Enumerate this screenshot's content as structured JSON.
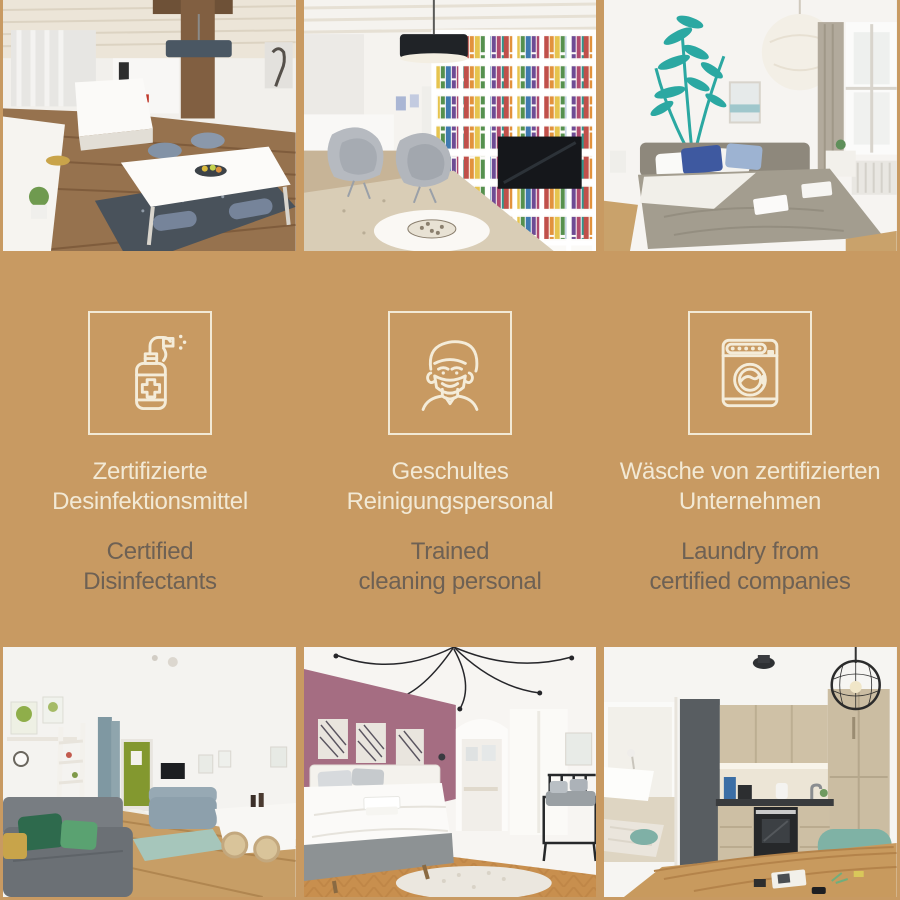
{
  "theme": {
    "background_color": "#c89a62",
    "title_color": "#f2e9d5",
    "subtitle_color": "#6e6154",
    "icon_color": "#f4ecd9"
  },
  "photo_grid": {
    "top": [
      {
        "id": "photo-open-plan-living-dining"
      },
      {
        "id": "photo-library-lounge"
      },
      {
        "id": "photo-bedroom-fern-decal"
      }
    ],
    "bottom": [
      {
        "id": "photo-living-room-green-accents"
      },
      {
        "id": "photo-bedroom-purple-wall"
      },
      {
        "id": "photo-kitchen-dining"
      }
    ]
  },
  "banner": {
    "features": [
      {
        "icon": "disinfectant-spray-icon",
        "title_de_lines": [
          "Zertifizierte",
          "Desinfektionsmittel"
        ],
        "subtitle_en_lines": [
          "Certified",
          "Disinfectants"
        ]
      },
      {
        "icon": "masked-cleaner-icon",
        "title_de_lines": [
          "Geschultes",
          "Reinigungspersonal"
        ],
        "subtitle_en_lines": [
          "Trained",
          "cleaning personal"
        ]
      },
      {
        "icon": "washing-machine-icon",
        "title_de_lines": [
          "Wäsche von zertifizierten",
          "Unternehmen"
        ],
        "subtitle_en_lines": [
          "Laundry from",
          "certified companies"
        ]
      }
    ]
  }
}
